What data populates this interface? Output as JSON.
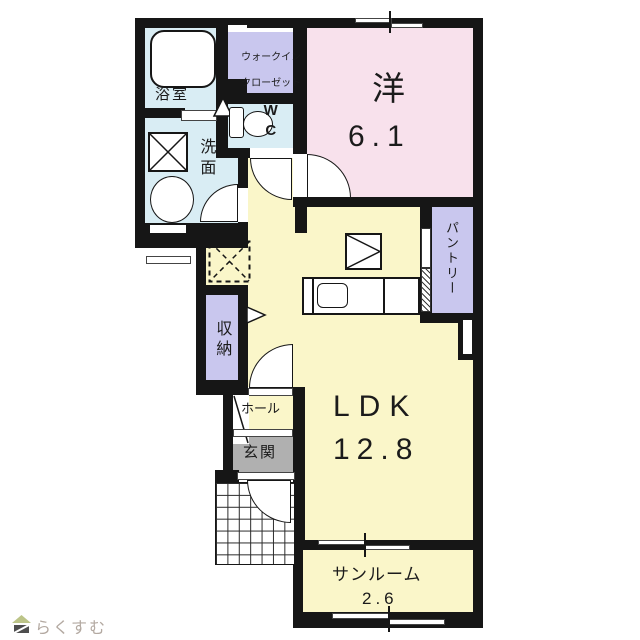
{
  "floorplan": {
    "rooms": {
      "bathroom": {
        "label": "浴室"
      },
      "walk_in_closet": {
        "label_line1": "ウォークイン",
        "label_line2": "クローゼット"
      },
      "wc": {
        "label": "WC"
      },
      "washroom": {
        "label": "洗面"
      },
      "western_room": {
        "label": "洋",
        "size": "6.1"
      },
      "pantry": {
        "label": "パントリー"
      },
      "storage": {
        "label": "収納"
      },
      "hall": {
        "label": "ホール"
      },
      "entrance": {
        "label": "玄関"
      },
      "ldk": {
        "label": "LDK",
        "size": "12.8"
      },
      "sunroom": {
        "label": "サンルーム",
        "size": "2.6"
      }
    },
    "colors": {
      "wall": "#161616",
      "western_room_fill": "#f8e1ec",
      "ldk_fill": "#faf6c9",
      "water_area_fill": "#d9edf4",
      "closet_fill": "#c9c7ee",
      "entrance_fill": "#b0b0b0"
    }
  },
  "branding": {
    "logo_text": "らくすむ"
  }
}
